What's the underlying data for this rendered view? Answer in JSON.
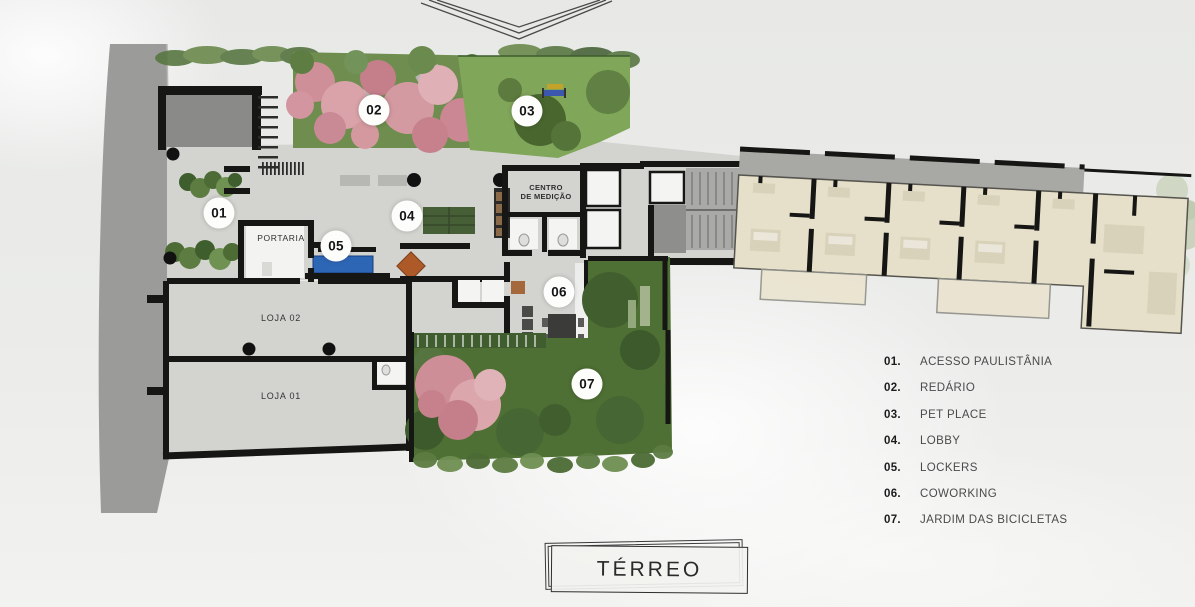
{
  "title": {
    "label": "TÉRREO"
  },
  "plan": {
    "markers": [
      {
        "label": "01"
      },
      {
        "label": "02"
      },
      {
        "label": "03"
      },
      {
        "label": "04"
      },
      {
        "label": "05"
      },
      {
        "label": "06"
      },
      {
        "label": "07"
      }
    ],
    "rooms": {
      "portaria": "PORTARIA",
      "loja02": "LOJA 02",
      "loja01": "LOJA 01",
      "centro_line1": "CENTRO",
      "centro_line2": "DE MEDIÇÃO"
    }
  },
  "legend": {
    "items": [
      {
        "num": "01.",
        "label": "ACESSO PAULISTÂNIA"
      },
      {
        "num": "02.",
        "label": "REDÁRIO"
      },
      {
        "num": "03.",
        "label": "PET PLACE"
      },
      {
        "num": "04.",
        "label": "LOBBY"
      },
      {
        "num": "05.",
        "label": "LOCKERS"
      },
      {
        "num": "06.",
        "label": "COWORKING"
      },
      {
        "num": "07.",
        "label": "JARDIM DAS BICICLETAS"
      }
    ]
  },
  "colors": {
    "background": "#e9eae8",
    "sidewalk": "#9b9c99",
    "slab_concrete": "#d3d4d0",
    "garage_gray": "#8a8b88",
    "wall_black": "#161614",
    "apartment_beige": "#e6dfc9",
    "corridor_gray": "#a8a9a5",
    "grass_green": "#7ea557",
    "garden_dark_green": "#4e7034",
    "blossom_pink": "#d49aa2",
    "lockers_blue": "#2e66b6",
    "lobby_rug_green": "#475f36",
    "accent_orange": "#ad5a28"
  }
}
